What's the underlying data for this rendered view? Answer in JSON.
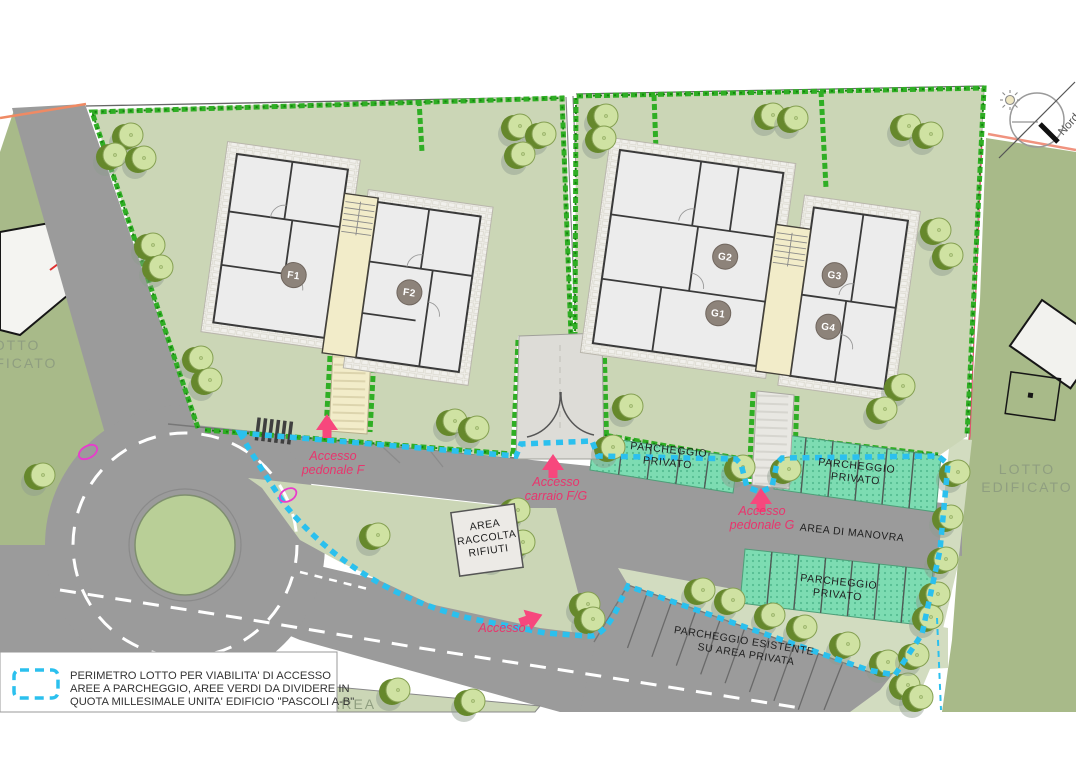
{
  "plan": {
    "compass_label": "Nord",
    "legend": {
      "lines": [
        "PERIMETRO LOTTO PER VIABILITA' DI ACCESSO",
        "AREE A PARCHEGGIO, AREE VERDI DA DIVIDERE IN",
        "QUOTA MILLESIMALE UNITA' EDIFICIO \"PASCOLI A-B\""
      ]
    },
    "units": {
      "f1": "F1",
      "f2": "F2",
      "g1": "G1",
      "g2": "G2",
      "g3": "G3",
      "g4": "G4"
    },
    "labels": {
      "parcheggio_privato_line1": "PARCHEGGIO",
      "parcheggio_privato_line2": "PRIVATO",
      "area_manovra": "AREA DI MANOVRA",
      "parcheggio_esistente_line1": "PARCHEGGIO ESISTENTE",
      "parcheggio_esistente_line2": "SU AREA PRIVATA",
      "rifiuti_line1": "AREA",
      "rifiuti_line2": "RACCOLTA",
      "rifiuti_line3": "RIFIUTI",
      "lotto_edificato_line1": "LOTTO",
      "lotto_edificato_line2": "EDIFICATO",
      "area_fragment": "AREA"
    },
    "access": {
      "pedonale_f_line1": "Accesso",
      "pedonale_f_line2": "pedonale F",
      "carraio_fg_line1": "Accesso",
      "carraio_fg_line2": "carraio F/G",
      "pedonale_g_line1": "Accesso",
      "pedonale_g_line2": "pedonale G",
      "accesso": "Accesso"
    },
    "colors": {
      "perimeter_cyan": "#2bc0ee",
      "access_red": "#e8356d",
      "arrow_pink": "#f7477d",
      "parking_teal": "#7ddcb2",
      "hedge_green": "#2fae24",
      "lawn_sage": "#cbd6b6",
      "outer_olive": "#a8ba89",
      "road_gray": "#9b9b9b"
    }
  }
}
